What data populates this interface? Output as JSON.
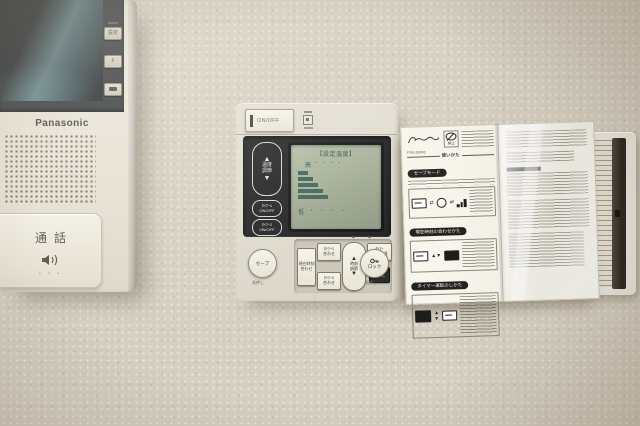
{
  "intercom": {
    "brand": "Panasonic",
    "side_button_1": "設定",
    "side_button_2": "F",
    "talk_label": "通話"
  },
  "controller": {
    "power_label": "ON/OFF",
    "lcd": {
      "title": "【設定温度】",
      "high_label": "高",
      "high_dashes": "- - - -",
      "low_label": "低",
      "low_dots": "・ ・ ・ ・",
      "bars": [
        10,
        15,
        20,
        25,
        30
      ]
    },
    "temp_rocker": {
      "up": "▲",
      "down": "▼",
      "line1": "温度",
      "line2": "調節"
    },
    "timer1_power": {
      "line1": "ﾀｲﾏｰ1",
      "line2": "ON/OFF"
    },
    "timer2_power": {
      "line1": "ﾀｲﾏｰ2",
      "line2": "ON/OFF"
    },
    "save": {
      "label": "セーブ",
      "hint": "長押し"
    },
    "clock_set": {
      "line1": "現在時刻",
      "line2": "合わせ"
    },
    "timer1_set": {
      "line1": "ﾀｲﾏｰ1",
      "line2": "合わせ"
    },
    "timer2_set": {
      "line1": "ﾀｲﾏｰ2",
      "line2": "合わせ"
    },
    "time_rocker": {
      "up": "▲",
      "down": "▼",
      "line1": "時刻",
      "line2": "調節"
    },
    "timer_check": {
      "line1": "ﾀｲﾏｰ",
      "line2": "確認取消"
    },
    "confirm_label": "確定",
    "lock": {
      "label": "ロック",
      "hint": "長押し"
    },
    "guide_arrows": "◀ ┈ ┈ ▶"
  },
  "card": {
    "model": "FSR-200N3",
    "prohibit_label": "禁止",
    "usage_header": "使いかた",
    "section_save": "セーブモード",
    "section_clock": "現在時刻の合わせかた",
    "section_timer": "タイマー運転のしかた"
  }
}
